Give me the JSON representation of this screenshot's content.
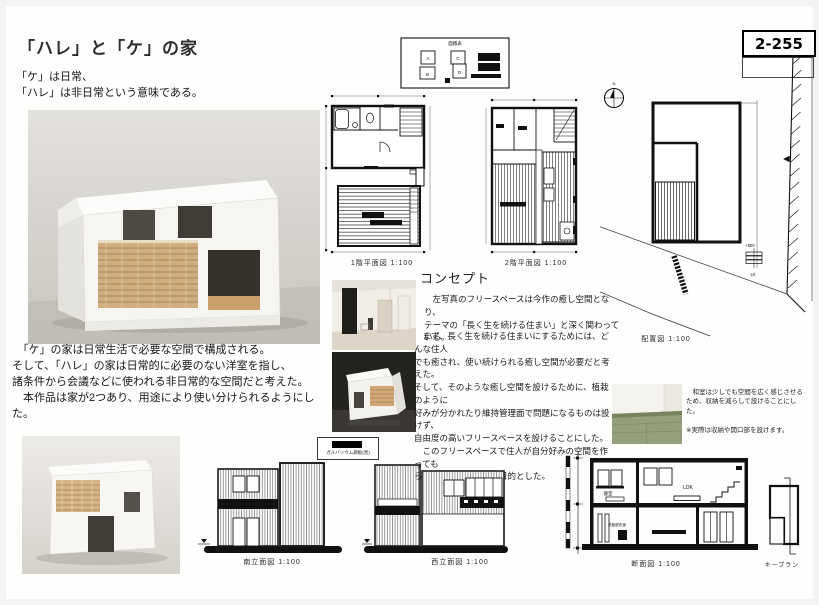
{
  "sheet": {
    "number": "2-255",
    "title": "「ハレ」と「ケ」の家"
  },
  "intro": "「ケ」は日常、\n「ハレ」は非日常という意味である。",
  "description": "　「ケ」の家は日常生活で必要な空間で構成される。\nそして、「ハレ」の家は日常的に必要のない洋室を指し、\n諸条件から会議などに使われる非日常的な空間だと考えた。\n　本作品は家が2つあり、用途により使い分けられるようにした。",
  "concept": {
    "heading": "コンセプト",
    "para1": "　左写真のフリースペースは今作の癒し空間となり、\nテーマの「長く生を続ける住まい」と深く関わっている。",
    "para2": "　まず、長く生を続ける住まいにするためには、どんな住人\nでも癒され、使い続けられる癒し空間が必要だと考えた。\nそして、そのような癒し空間を設けるために、植栽のように\n好みが分かれたり維持管理面で問題になるものは設けず、\n自由度の高いフリースペースを設けることにした。\n　このフリースペースで住人が自分好みの空間を作っても\nらい、癒されることを目的とした。"
  },
  "tatami_note": "　和室は少しでも空間を広く感じさせる\nため、収納を減らして設けることにし\nた。\n\n※実際は収納や開口部を設けます。",
  "labels": {
    "area_table": "面積表",
    "plan_1f": "1階平面図 1:100",
    "plan_2f": "2階平面図 1:100",
    "site": "配置図 1:100",
    "elev_south": "南立面図 1:100",
    "elev_west": "西立面図 1:100",
    "section": "断面図 1:100",
    "keyplan": "キープラン",
    "material": "ガルバリウム鋼板(黒)",
    "north": "N",
    "level_upper": "+500",
    "level_zero": "±0"
  },
  "section_rooms": {
    "bedroom": "寝室",
    "ldk": "LDK",
    "washroom": "洗面脱衣室"
  },
  "area_table_rooms": [
    "A",
    "B",
    "C",
    "D"
  ],
  "colors": {
    "ink": "#111111",
    "tatami": "#94a079",
    "wood": "#d0ab7d",
    "photo_bg": "#d9d6d0"
  }
}
